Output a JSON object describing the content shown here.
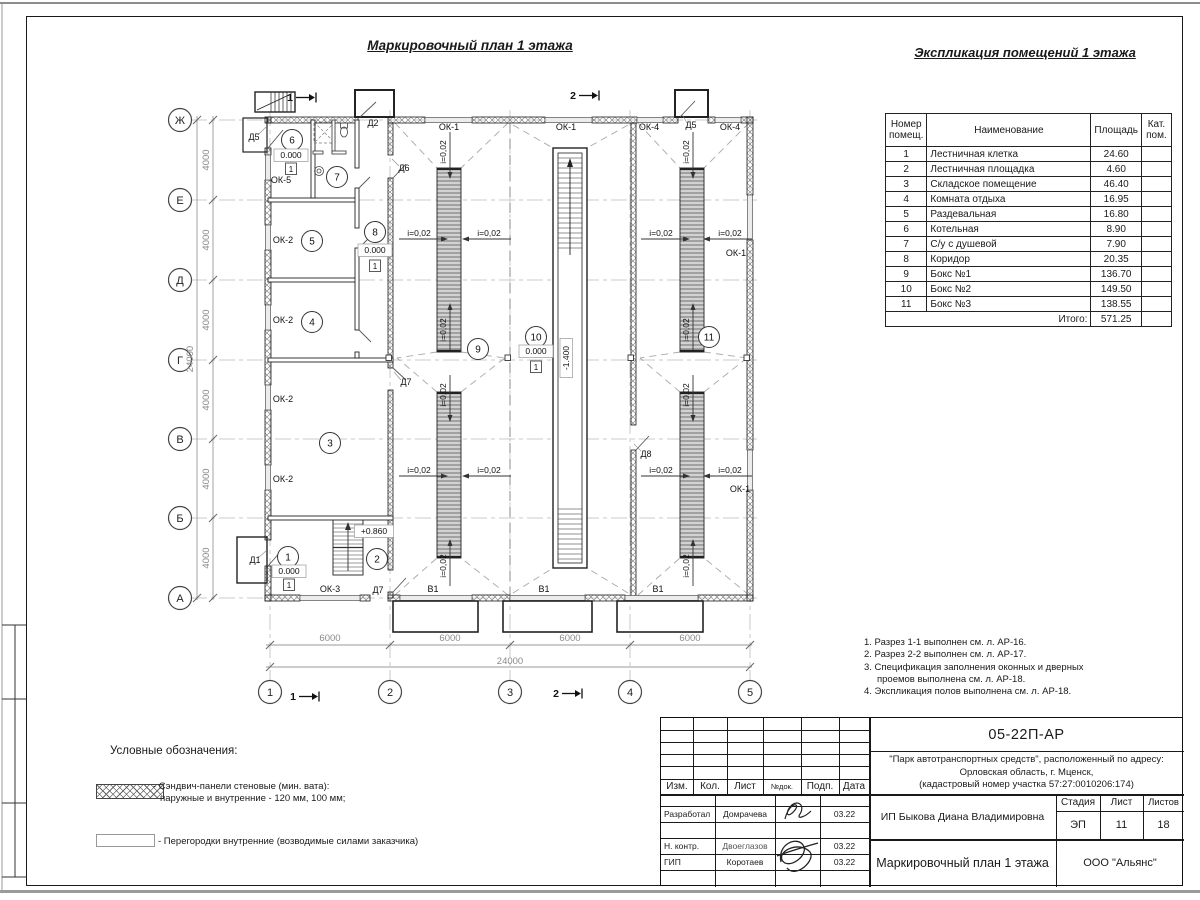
{
  "sheet": {
    "plan_title": "Маркировочный план 1 этажа",
    "table_title": "Экспликация помещений 1 этажа"
  },
  "explication": {
    "headers": {
      "col1": "Номер\nпомещ.",
      "col2": "Наименование",
      "col3": "Площадь",
      "col4": "Кат.\nпом."
    },
    "rows": [
      [
        "1",
        "Лестничная клетка",
        "24.60"
      ],
      [
        "2",
        "Лестничная площадка",
        "4.60"
      ],
      [
        "3",
        "Складское помещение",
        "46.40"
      ],
      [
        "4",
        "Комната отдыха",
        "16.95"
      ],
      [
        "5",
        "Раздевальная",
        "16.80"
      ],
      [
        "6",
        "Котельная",
        "8.90"
      ],
      [
        "7",
        "С/у с душевой",
        "7.90"
      ],
      [
        "8",
        "Коридор",
        "20.35"
      ],
      [
        "9",
        "Бокс №1",
        "136.70"
      ],
      [
        "10",
        "Бокс №2",
        "149.50"
      ],
      [
        "11",
        "Бокс №3",
        "138.55"
      ]
    ],
    "total_label": "Итого:",
    "total_value": "571.25"
  },
  "notes": {
    "items": [
      "1. Разрез 1-1 выполнен см. л. АР-16.",
      "2. Разрез 2-2 выполнен см. л. АР-17.",
      "3. Спецификация заполнения оконных и дверных проемов выполнена см. л. АР-18.",
      "4. Экспликация полов выполнена см. л. АР-18."
    ]
  },
  "legend": {
    "title": "Условные обозначения:",
    "items": [
      {
        "line1": "- Сэндвич-панели стеновые (мин. вата):",
        "line2": "наружные и внутренние - 120 мм, 100 мм;"
      },
      {
        "line1": "- Перегородки внутренние (возводимые силами заказчика)"
      }
    ]
  },
  "titleblock": {
    "doc_number": "05-22П-АР",
    "project_line1": "\"Парк автотранспортных средств\",  расположенный по адресу:",
    "project_line2": "Орловская область, г. Мценск,",
    "project_line3": "(кадастровый номер участка 57:27:0010206:174)",
    "client": "ИП Быкова Диана Владимировна",
    "sheet_title": "Маркировочный план 1 этажа",
    "company": "ООО \"Альянс\"",
    "stage_label": "Стадия",
    "stage": "ЭП",
    "sheet_label": "Лист",
    "sheet_no": "11",
    "sheets_label": "Листов",
    "sheets_total": "18",
    "cols": [
      "Изм.",
      "Кол.",
      "Лист",
      "№док.",
      "Подп.",
      "Дата"
    ],
    "crew": [
      {
        "role": "Разработал",
        "name": "Домрачева",
        "date": "03.22"
      },
      {
        "role": "Н. контр.",
        "name": "Двоеглазов",
        "date": "03.22"
      },
      {
        "role": "ГИП",
        "name": "Коротаев",
        "date": "03.22"
      }
    ]
  },
  "plan": {
    "axis_rows": [
      {
        "label": "Ж",
        "y": 120
      },
      {
        "label": "Е",
        "y": 200
      },
      {
        "label": "Д",
        "y": 280
      },
      {
        "label": "Г",
        "y": 360
      },
      {
        "label": "В",
        "y": 439
      },
      {
        "label": "Б",
        "y": 518
      },
      {
        "label": "А",
        "y": 598
      }
    ],
    "axis_cols": [
      {
        "label": "1",
        "x": 270
      },
      {
        "label": "2",
        "x": 390
      },
      {
        "label": "3",
        "x": 510
      },
      {
        "label": "4",
        "x": 630
      },
      {
        "label": "5",
        "x": 750
      }
    ],
    "room_bubbles": [
      {
        "n": "1",
        "x": 288,
        "y": 557
      },
      {
        "n": "2",
        "x": 377,
        "y": 559
      },
      {
        "n": "3",
        "x": 330,
        "y": 443
      },
      {
        "n": "4",
        "x": 312,
        "y": 322
      },
      {
        "n": "5",
        "x": 312,
        "y": 241
      },
      {
        "n": "6",
        "x": 292,
        "y": 140
      },
      {
        "n": "7",
        "x": 337,
        "y": 177
      },
      {
        "n": "8",
        "x": 375,
        "y": 232
      },
      {
        "n": "9",
        "x": 478,
        "y": 349
      },
      {
        "n": "10",
        "x": 536,
        "y": 337
      },
      {
        "n": "11",
        "x": 709,
        "y": 337
      }
    ],
    "labels": [
      {
        "t": "Д5",
        "x": 254,
        "y": 140
      },
      {
        "t": "ОК-5",
        "x": 281,
        "y": 183
      },
      {
        "t": "Д2",
        "x": 373,
        "y": 126
      },
      {
        "t": "Д6",
        "x": 404,
        "y": 171
      },
      {
        "t": "ОК-1",
        "x": 449,
        "y": 130
      },
      {
        "t": "ОК-1",
        "x": 566,
        "y": 130
      },
      {
        "t": "ОК-4",
        "x": 649,
        "y": 130
      },
      {
        "t": "Д5",
        "x": 691,
        "y": 128
      },
      {
        "t": "ОК-4",
        "x": 730,
        "y": 130
      },
      {
        "t": "ОК-2",
        "x": 283,
        "y": 243
      },
      {
        "t": "ОК-2",
        "x": 283,
        "y": 323
      },
      {
        "t": "ОК-2",
        "x": 283,
        "y": 402
      },
      {
        "t": "ОК-2",
        "x": 283,
        "y": 482
      },
      {
        "t": "Д7",
        "x": 406,
        "y": 385
      },
      {
        "t": "Д8",
        "x": 646,
        "y": 457
      },
      {
        "t": "ОК-1",
        "x": 736,
        "y": 256
      },
      {
        "t": "ОК-1",
        "x": 740,
        "y": 492
      },
      {
        "t": "Д1",
        "x": 255,
        "y": 563
      },
      {
        "t": "ОК-3",
        "x": 330,
        "y": 592
      },
      {
        "t": "Д7",
        "x": 378,
        "y": 593
      },
      {
        "t": "В1",
        "x": 433,
        "y": 592
      },
      {
        "t": "В1",
        "x": 544,
        "y": 592
      },
      {
        "t": "В1",
        "x": 658,
        "y": 592
      }
    ],
    "slopes": [
      {
        "t": "i=0,02",
        "x": 419,
        "y": 236,
        "r": 0,
        "dir": "right"
      },
      {
        "t": "i=0,02",
        "x": 489,
        "y": 236,
        "r": 0,
        "dir": "left"
      },
      {
        "t": "i=0,02",
        "x": 661,
        "y": 236,
        "r": 0,
        "dir": "right"
      },
      {
        "t": "i=0,02",
        "x": 730,
        "y": 236,
        "r": 0,
        "dir": "left"
      },
      {
        "t": "i=0,02",
        "x": 419,
        "y": 473,
        "r": 0,
        "dir": "right"
      },
      {
        "t": "i=0,02",
        "x": 489,
        "y": 473,
        "r": 0,
        "dir": "left"
      },
      {
        "t": "i=0,02",
        "x": 661,
        "y": 473,
        "r": 0,
        "dir": "right"
      },
      {
        "t": "i=0,02",
        "x": 730,
        "y": 473,
        "r": 0,
        "dir": "left"
      },
      {
        "t": "i=0,02",
        "x": 446,
        "y": 152,
        "r": -90,
        "dir": "down"
      },
      {
        "t": "i=0,02",
        "x": 689,
        "y": 152,
        "r": -90,
        "dir": "down"
      },
      {
        "t": "i=0,02",
        "x": 446,
        "y": 330,
        "r": -90,
        "dir": "up"
      },
      {
        "t": "i=0,02",
        "x": 689,
        "y": 330,
        "r": -90,
        "dir": "up"
      },
      {
        "t": "i=0,02",
        "x": 446,
        "y": 395,
        "r": -90,
        "dir": "down"
      },
      {
        "t": "i=0,02",
        "x": 689,
        "y": 395,
        "r": -90,
        "dir": "down"
      },
      {
        "t": "i=0,02",
        "x": 446,
        "y": 566,
        "r": -90,
        "dir": "up"
      },
      {
        "t": "i=0,02",
        "x": 689,
        "y": 566,
        "r": -90,
        "dir": "up"
      }
    ],
    "elev_marks": [
      {
        "t": "0.000",
        "x": 291,
        "y": 158,
        "r": 0
      },
      {
        "t": "0.000",
        "x": 375,
        "y": 253,
        "r": 0
      },
      {
        "t": "0.000",
        "x": 536,
        "y": 354,
        "r": 0
      },
      {
        "t": "0.000",
        "x": 289,
        "y": 574,
        "r": 0
      },
      {
        "t": "+0.860",
        "x": 374,
        "y": 534,
        "r": 0
      },
      {
        "t": "-1.400",
        "x": 569,
        "y": 358,
        "r": -90
      }
    ],
    "floor_marks": [
      {
        "t": "1",
        "x": 291,
        "y": 172
      },
      {
        "t": "1",
        "x": 375,
        "y": 269
      },
      {
        "t": "1",
        "x": 536,
        "y": 370
      },
      {
        "t": "1",
        "x": 289,
        "y": 588
      }
    ],
    "dims_v": [
      {
        "t": "4000",
        "x": 209,
        "y": 160
      },
      {
        "t": "4000",
        "x": 209,
        "y": 240
      },
      {
        "t": "4000",
        "x": 209,
        "y": 320
      },
      {
        "t": "4000",
        "x": 209,
        "y": 400
      },
      {
        "t": "4000",
        "x": 209,
        "y": 479
      },
      {
        "t": "4000",
        "x": 209,
        "y": 558
      },
      {
        "t": "24000",
        "x": 193,
        "y": 359
      }
    ],
    "dims_h": [
      {
        "t": "6000",
        "x": 330,
        "y": 641
      },
      {
        "t": "6000",
        "x": 450,
        "y": 641
      },
      {
        "t": "6000",
        "x": 570,
        "y": 641
      },
      {
        "t": "6000",
        "x": 690,
        "y": 641
      },
      {
        "t": "24000",
        "x": 510,
        "y": 664
      }
    ],
    "sections": [
      {
        "t": "1",
        "x": 290,
        "y": 101
      },
      {
        "t": "2",
        "x": 573,
        "y": 99
      },
      {
        "t": "1",
        "x": 293,
        "y": 700
      },
      {
        "t": "2",
        "x": 556,
        "y": 697
      }
    ]
  }
}
